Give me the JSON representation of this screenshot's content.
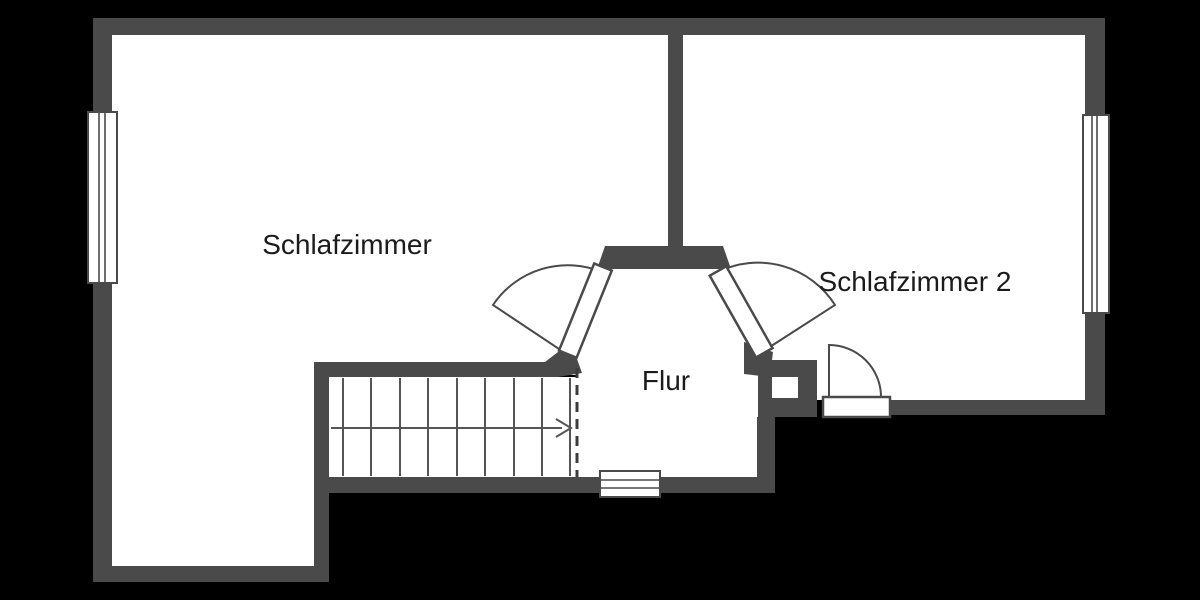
{
  "floorplan": {
    "title": "Obergeschoss Grundriss",
    "rooms": [
      {
        "id": "schlafzimmer",
        "label": "Schlafzimmer"
      },
      {
        "id": "schlafzimmer-2",
        "label": "Schlafzimmer 2"
      },
      {
        "id": "flur",
        "label": "Flur"
      }
    ],
    "elements": {
      "windows": 3,
      "doors": 3,
      "staircase": {
        "treads": 9,
        "direction_arrow": "right"
      }
    },
    "colors": {
      "background": "#000000",
      "wall": "#4a4a4a",
      "floor": "#ffffff",
      "stair_line": "#555555",
      "text": "#1b1b1b"
    }
  }
}
